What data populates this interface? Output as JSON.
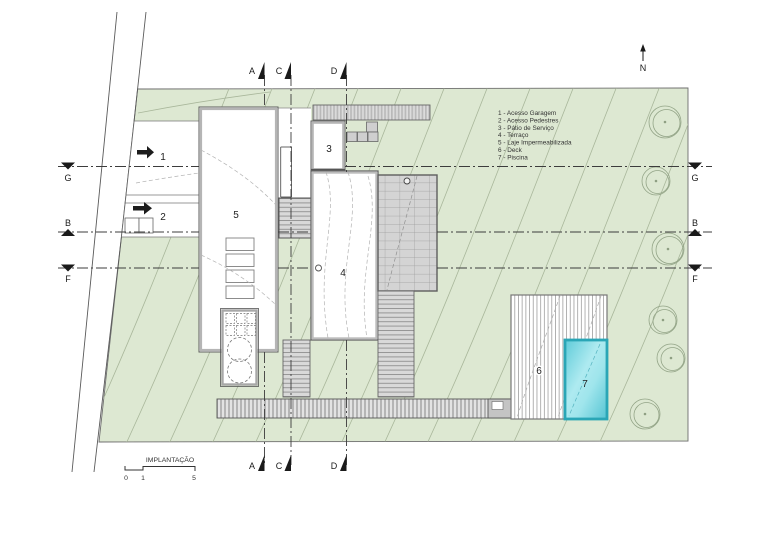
{
  "drawing_title": "IMPLANTAÇÃO",
  "legend": {
    "items": [
      {
        "text": "1 - Acesso Garagem"
      },
      {
        "text": "2 - Acesso Pedestres"
      },
      {
        "text": "3 - Pátio de Serviço"
      },
      {
        "text": "4 - Terraço"
      },
      {
        "text": "5 - Laje Impermeabilizada"
      },
      {
        "text": "6 - Deck"
      },
      {
        "text": "7 - Piscina"
      }
    ]
  },
  "zone_labels": {
    "garage_access": "1",
    "pedestrian_access": "2",
    "service_patio": "3",
    "terrace": "4",
    "waterproof_slab": "5",
    "deck": "6",
    "pool": "7"
  },
  "section_markers": {
    "a": "A",
    "b": "B",
    "c": "C",
    "d": "D",
    "f": "F",
    "g": "G"
  },
  "north": {
    "label": "N"
  },
  "scale_bar": {
    "title": "IMPLANTAÇÃO",
    "ticks": [
      "0",
      "1",
      "5"
    ]
  },
  "colors": {
    "site_green": "#dde8d2",
    "contour_line": "#a9b79b",
    "pool_fill": "#7fd9e4",
    "pool_border": "#2aa6b6",
    "hatch_gray": "#d6d6d6",
    "line_dark": "#555555"
  }
}
